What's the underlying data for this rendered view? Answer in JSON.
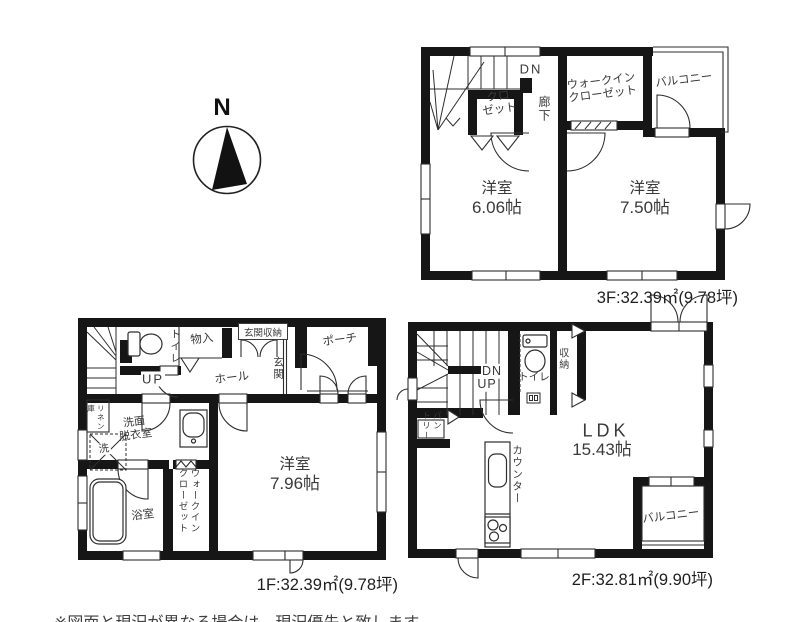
{
  "compass": {
    "north": "N"
  },
  "floor3": {
    "area_label": "3F:32.39㎡(9.78坪)",
    "dn": "DN",
    "closet": [
      "クロ",
      "ゼット"
    ],
    "hallway": "廊下",
    "wic": [
      "ウォークイン",
      "クローゼット"
    ],
    "balcony": "バルコニー",
    "room1": [
      "洋室",
      "6.06帖"
    ],
    "room2": [
      "洋室",
      "7.50帖"
    ]
  },
  "floor1": {
    "area_label": "1F:32.39㎡(9.78坪)",
    "up": "UP",
    "toilet": "トイレ",
    "storage": "物入",
    "entrance_storage": "玄関収納",
    "entrance": "玄関",
    "porch": "ポーチ",
    "hall": "ホール",
    "linen": [
      "リネン",
      "庫"
    ],
    "washroom": [
      "洗面",
      "脱衣室"
    ],
    "washer": "洗",
    "bathroom": "浴室",
    "wic": [
      "ウォークイン",
      "クローゼット"
    ],
    "room": [
      "洋室",
      "7.96帖"
    ]
  },
  "floor2": {
    "area_label": "2F:32.81㎡(9.90坪)",
    "dn": "DN",
    "up": "UP",
    "toilet": "トイレ",
    "storage": "収納",
    "pantry": [
      "パン",
      "トリー"
    ],
    "counter": "カウンター",
    "ldk": [
      "LDK",
      "15.43帖"
    ],
    "balcony": "バルコニー"
  },
  "footnote": {
    "text": "※図面と現況が異なる場合は、現況優先と致します。"
  }
}
